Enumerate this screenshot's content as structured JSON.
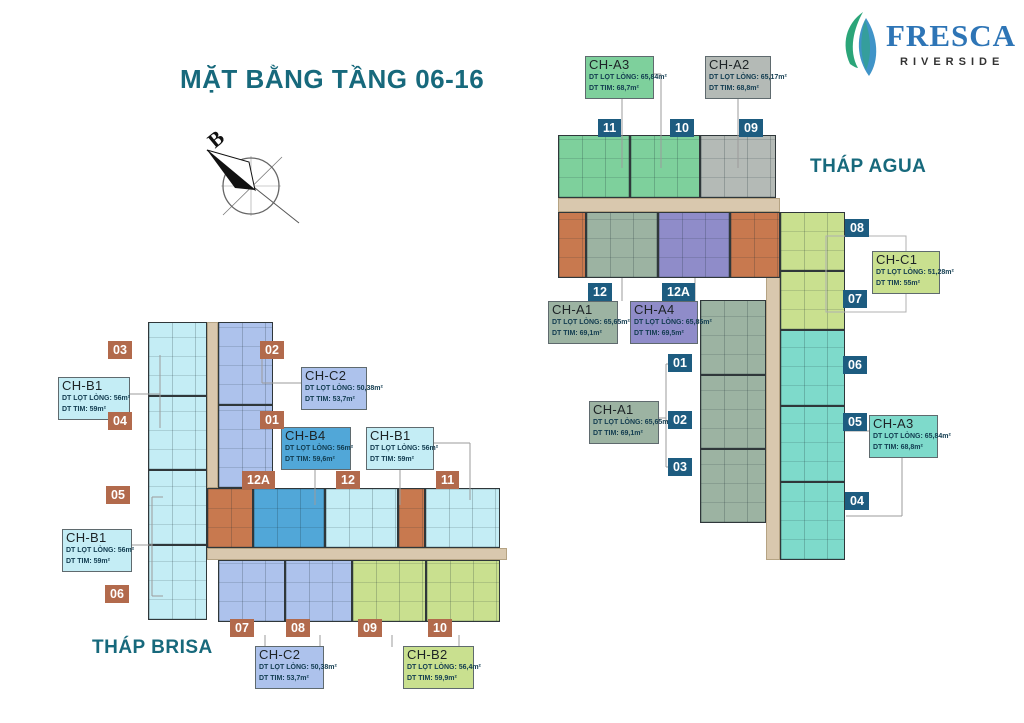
{
  "page": {
    "title": "MẶT BẰNG TẦNG 06-16"
  },
  "logo": {
    "brand": "FRESCA",
    "sub": "RIVERSIDE"
  },
  "compass": {
    "north": "B"
  },
  "towers": {
    "agua": "THÁP AGUA",
    "brisa": "THÁP BRISA"
  },
  "badges": {
    "agua": [
      "11",
      "10",
      "09",
      "12",
      "12A",
      "01",
      "02",
      "03",
      "08",
      "07",
      "06",
      "05",
      "04"
    ],
    "brisa": [
      "03",
      "02",
      "04",
      "01",
      "05",
      "06",
      "12A",
      "12",
      "11",
      "07",
      "08",
      "09",
      "10"
    ]
  },
  "labels": {
    "cha3_top": {
      "name": "CH-A3",
      "net": "DT LỌT LÒNG: 65,84m²",
      "gross": "DT TIM: 68,7m²"
    },
    "cha2": {
      "name": "CH-A2",
      "net": "DT LỌT LÒNG: 65,17m²",
      "gross": "DT TIM: 68,8m²"
    },
    "chc1": {
      "name": "CH-C1",
      "net": "DT LỌT LÒNG: 51,28m²",
      "gross": "DT TIM: 55m²"
    },
    "cha1_top": {
      "name": "CH-A1",
      "net": "DT LỌT LÒNG: 65,65m²",
      "gross": "DT TIM: 69,1m²"
    },
    "cha4": {
      "name": "CH-A4",
      "net": "DT LỌT LÒNG: 65,85m²",
      "gross": "DT TIM: 69,5m²"
    },
    "cha1_mid": {
      "name": "CH-A1",
      "net": "DT LỌT LÒNG: 65,65m²",
      "gross": "DT TIM: 69,1m²"
    },
    "cha3_right": {
      "name": "CH-A3",
      "net": "DT LỌT LÒNG: 65,84m²",
      "gross": "DT TIM: 68,8m²"
    },
    "chb1_top": {
      "name": "CH-B1",
      "net": "DT LỌT LÒNG: 56m²",
      "gross": "DT TIM: 59m²"
    },
    "chc2_top": {
      "name": "CH-C2",
      "net": "DT LỌT LÒNG: 50,38m²",
      "gross": "DT TIM: 53,7m²"
    },
    "chb4": {
      "name": "CH-B4",
      "net": "DT LỌT LÒNG: 56m²",
      "gross": "DT TIM: 59,6m²"
    },
    "chb1_mid": {
      "name": "CH-B1",
      "net": "DT LỌT LÒNG: 56m²",
      "gross": "DT TIM: 59m²"
    },
    "chb1_low": {
      "name": "CH-B1",
      "net": "DT LỌT LÒNG: 56m²",
      "gross": "DT TIM: 59m²"
    },
    "chc2_bot": {
      "name": "CH-C2",
      "net": "DT LỌT LÒNG: 50,38m²",
      "gross": "DT TIM: 53,7m²"
    },
    "chb2": {
      "name": "CH-B2",
      "net": "DT LỌT LÒNG: 56,4m²",
      "gross": "DT TIM: 59,9m²"
    }
  },
  "colors": {
    "accent_teal": "#17697c",
    "badge_agua": "#1d5c80",
    "badge_brisa": "#b26a4c",
    "logo_blue": "#2e75b6",
    "leaf_green": "#2ba579",
    "leaf_blue": "#4094c8",
    "corridor_tan": "#d9c8ae",
    "core_orange": "#c8794f",
    "type_green": "#7ed09c",
    "type_gray": "#b4bab6",
    "type_sage": "#9cb3a2",
    "type_purple": "#8f8cc9",
    "type_yellow_green": "#c9e08f",
    "type_teal": "#7edacb",
    "type_pale_cyan": "#c4edf5",
    "type_periwinkle": "#adc2ec",
    "type_medium_blue": "#51a7d8"
  }
}
